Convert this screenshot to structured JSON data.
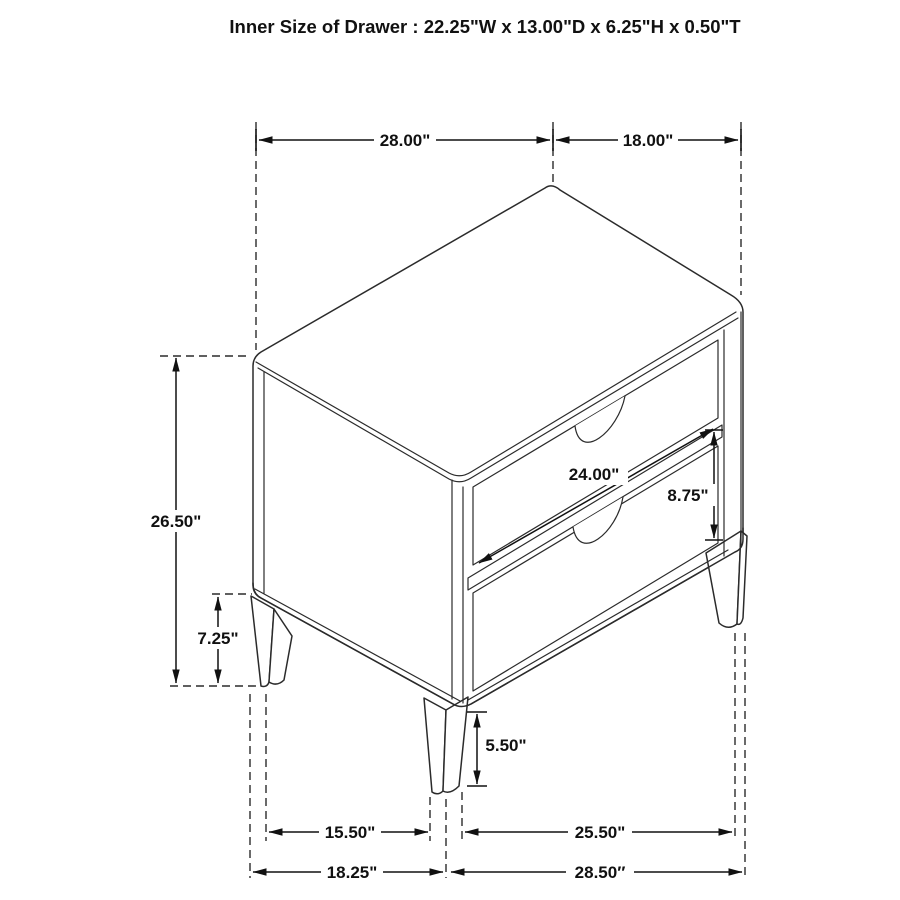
{
  "title": "Inner Size of Drawer : 22.25\"W x 13.00\"D x 6.25\"H x 0.50\"T",
  "diagram": {
    "type": "isometric-furniture-dimension-drawing",
    "subject": "two-drawer nightstand with fluted drawer fronts and tapered legs",
    "dimensions": {
      "top_width": "28.00\"",
      "top_depth": "18.00\"",
      "overall_height": "26.50\"",
      "bottom_clearance": "7.25\"",
      "drawer_front_width": "24.00\"",
      "drawer_front_height": "8.75\"",
      "leg_height": "5.50\"",
      "front_leg_span": "15.50\"",
      "side_leg_span": "25.50\"",
      "front_base_width": "18.25\"",
      "side_base_depth": "28.50″"
    }
  },
  "colors": {
    "background": "#ffffff",
    "line": "#2b2b2b",
    "dimension": "#111111",
    "flute": "#4a4a4a"
  }
}
